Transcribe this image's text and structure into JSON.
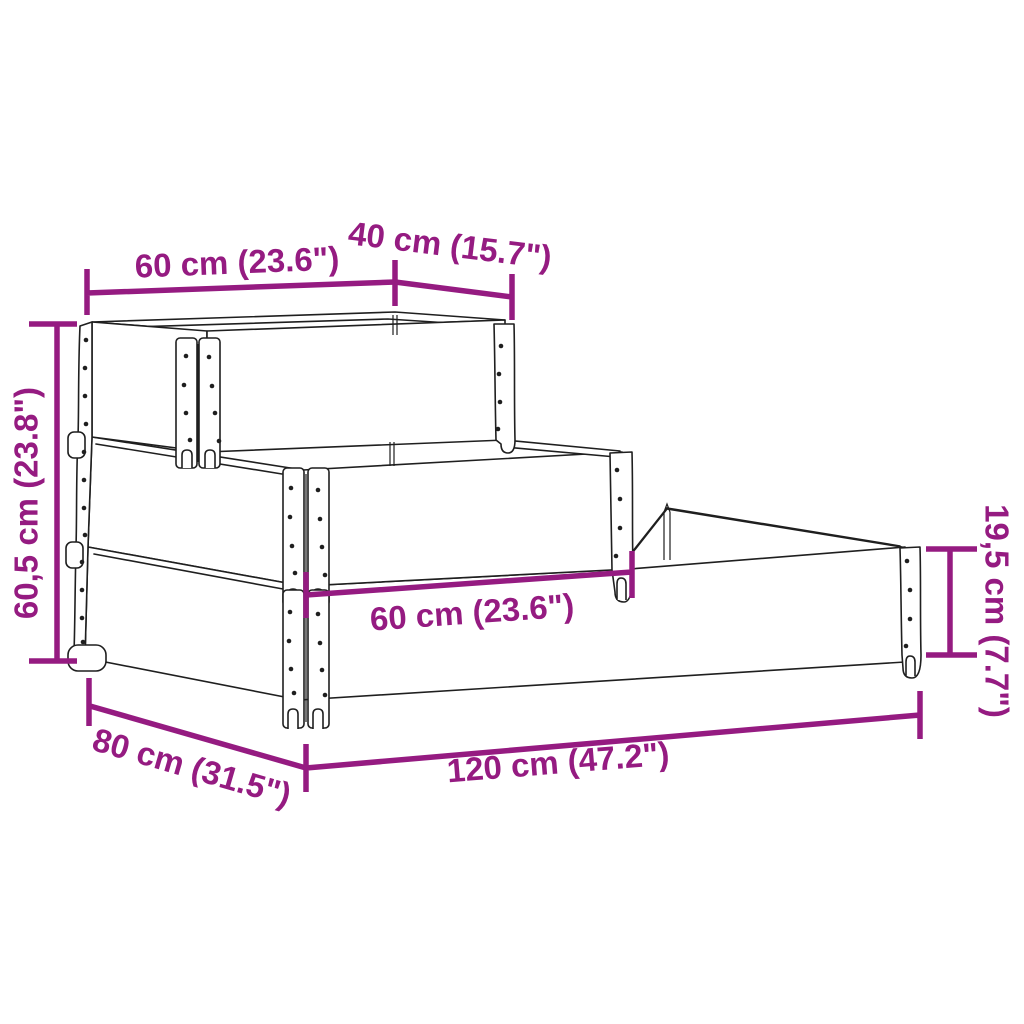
{
  "figure": "3-tier wooden raised garden bed (pallet collar planter) dimension diagram",
  "accent_color": "#951B81",
  "drawing_color": "#1f1f1f",
  "background_color": "#ffffff",
  "dims": {
    "top_length": "60 cm (23.6\")",
    "top_width": "40 cm (15.7\")",
    "total_height": "60,5 cm (23.8\")",
    "collar_height": "19,5 cm (7.7\")",
    "middle_length": "60 cm (23.6\")",
    "base_width": "80 cm (31.5\")",
    "base_length": "120 cm (47.2\")"
  }
}
